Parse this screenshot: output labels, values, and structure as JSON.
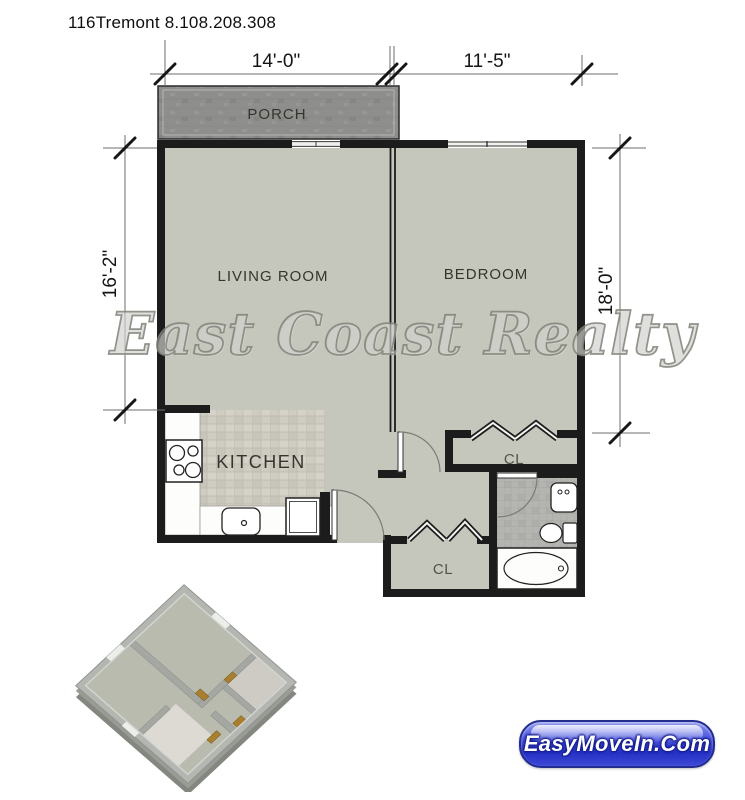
{
  "header": {
    "title": "116Tremont 8.108.208.308"
  },
  "rooms": {
    "porch": "PORCH",
    "living_room": "LIVING ROOM",
    "bedroom": "BEDROOM",
    "kitchen": "KITCHEN",
    "bedroom_closet": "CL",
    "entry_closet": "CL"
  },
  "dimensions": {
    "top_left_width": "14'-0\"",
    "top_right_width": "11'-5\"",
    "left_height": "16'-2\"",
    "right_height": "18'-0\""
  },
  "watermark": {
    "text": "East Coast Realty"
  },
  "badge": {
    "label": "EasyMoveIn.Com"
  },
  "colors": {
    "wall": "#1c1c1c",
    "floor": "#c6c7bc",
    "porch": "#8e8e8c",
    "kitchen_tile": "#cfccc1",
    "bath_tile": "#b4b4b0",
    "badge_blue": "#3a45cf",
    "watermark_gray": "#8a8d84"
  },
  "thumbnail_3d": {
    "name": "3d-isometric-floorplan-preview"
  }
}
